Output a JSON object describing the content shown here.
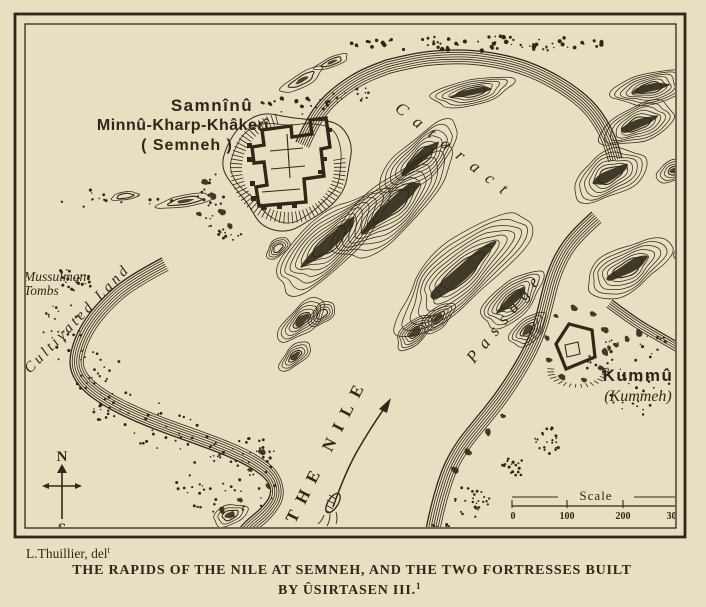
{
  "map": {
    "labels": {
      "semneh_fort_line1": "Samnînû",
      "semneh_fort_line2": "Minnû-Kharp-Khâkerî",
      "semneh_fort_line3": "( Semneh )",
      "kummeh_fort_name": "Kummû",
      "kummeh_fort_alt": "(Kummeh)",
      "cataract": "Cataract",
      "passage": "Passage",
      "river": "THE NILE",
      "tombs_line1": "Mussulman",
      "tombs_line2": "Tombs",
      "cultivated_land": "Cultivated Land"
    },
    "compass": {
      "north": "N",
      "south": "S"
    },
    "scale_bar": {
      "label": "Scale",
      "ticks": [
        "0",
        "100",
        "200",
        "300"
      ]
    }
  },
  "title_block": {
    "credit": "L.Thuillier, del",
    "credit_superscript": "t",
    "caption_line1": "THE RAPIDS OF THE NILE AT SEMNEH, AND THE TWO FORTRESSES BUILT",
    "caption_line2": "BY ÛSIRTASEN III.",
    "caption_line2_superscript": "1"
  },
  "colors": {
    "paper": "#e8dec2",
    "ink": "#2e2817"
  }
}
